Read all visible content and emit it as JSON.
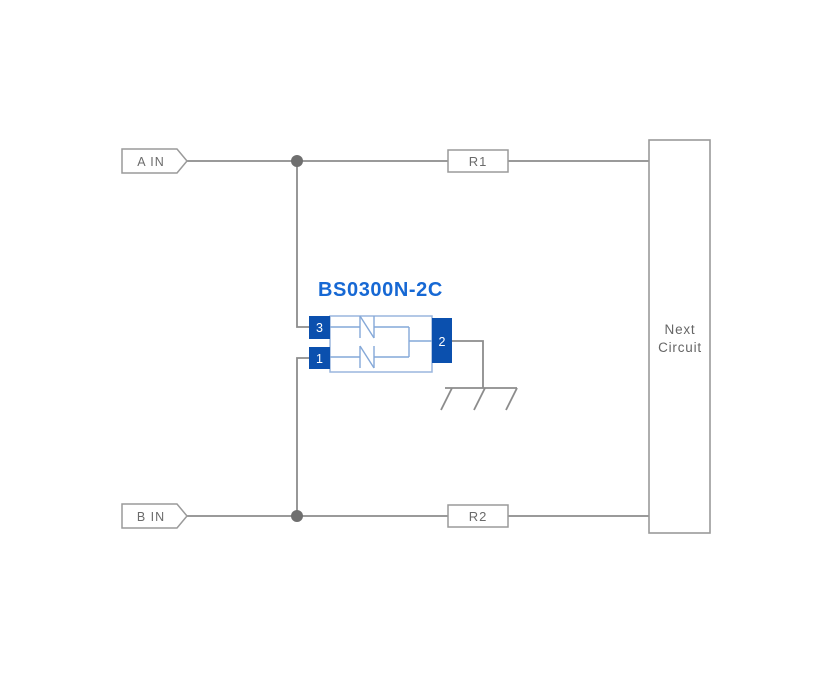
{
  "diagram": {
    "component": {
      "name": "BS0300N-2C",
      "pins": {
        "top_left": "3",
        "bottom_left": "1",
        "right": "2"
      }
    },
    "inputs": {
      "a": "A IN",
      "b": "B IN"
    },
    "resistors": {
      "r1": "R1",
      "r2": "R2"
    },
    "next_circuit": {
      "line1": "Next",
      "line2": "Circuit"
    },
    "colors": {
      "background": "#ffffff",
      "wire_gray": "#8c8c8c",
      "outline_gray": "#9a9a9a",
      "label_gray": "#6b6b6b",
      "junction_gray": "#6f6f6f",
      "pin_blue": "#0b50ae",
      "component_border_blue": "#9ab6de",
      "internal_line_blue": "#84a8d8",
      "title_blue": "#1668d4"
    }
  }
}
